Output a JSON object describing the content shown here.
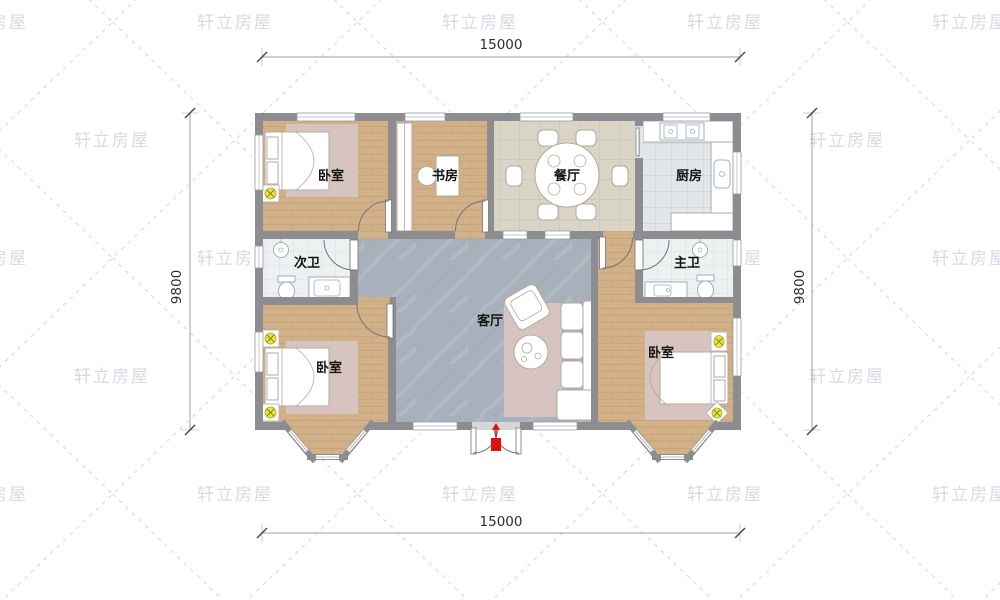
{
  "watermark": {
    "text": "轩立房屋"
  },
  "dimensions": {
    "top": "15000",
    "bottom": "15000",
    "left": "9800",
    "right": "9800"
  },
  "rooms": {
    "bedroom_top_left": {
      "label": "卧室"
    },
    "study": {
      "label": "书房"
    },
    "dining": {
      "label": "餐厅"
    },
    "kitchen": {
      "label": "厨房"
    },
    "bath_secondary": {
      "label": "次卫"
    },
    "bath_master": {
      "label": "主卫"
    },
    "living": {
      "label": "客厅"
    },
    "bedroom_bottom_left": {
      "label": "卧室"
    },
    "bedroom_bottom_right": {
      "label": "卧室"
    }
  },
  "colors": {
    "wall": "#8c8c91",
    "wood": "#d2b189",
    "tile_living": "#a8b1bb",
    "dining_floor": "#d8d4c6",
    "kitchen_floor": "#e2e6e9",
    "bath_floor": "#eef1f2",
    "rug": "#d7c3bf",
    "light_yellow": "#e9e43a",
    "entry_red": "#e01010",
    "watermark": "#cdd2df",
    "label_text": "#141414",
    "dim_text": "#2e2e2e",
    "furn_stroke": "#b3a99c"
  }
}
